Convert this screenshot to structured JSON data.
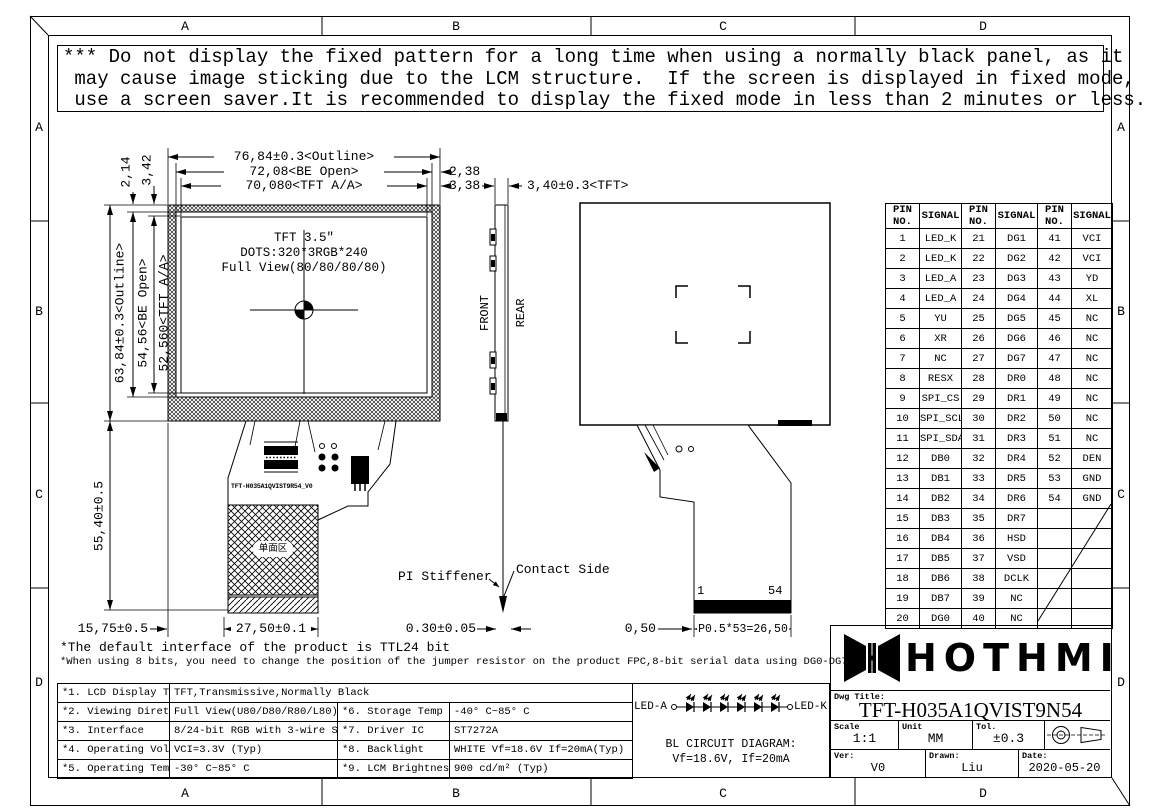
{
  "border": {
    "top": [
      "A",
      "B",
      "C",
      "D"
    ],
    "bottom": [
      "A",
      "B",
      "C",
      "D"
    ],
    "left": [
      "A",
      "B",
      "C",
      "D"
    ],
    "right": [
      "A",
      "B",
      "C",
      "D"
    ]
  },
  "warning": {
    "line1": "*** Do not display the fixed pattern for a long time when using a normally black panel, as it",
    "line2": " may cause image sticking due to the LCM structure.  If the screen is displayed in fixed mode,",
    "line3": " use a screen saver.It is recommended to display the fixed mode in less than 2 minutes or less."
  },
  "front_view": {
    "line1": "TFT 3.5″",
    "line2": "DOTS:320*3RGB*240",
    "line3": "Full View(80/80/80/80)",
    "fpc_part_number": "TFT-H035A1QVIST9R54_V0",
    "stiffener_area_label": "单面区"
  },
  "dims": {
    "outline_w": "76,84±0.3<Outline>",
    "be_open_w": "72,08<BE Open>",
    "tft_aa_w": "70,080<TFT A/A>",
    "right_margin": "2,38",
    "aa_margin": "3,38",
    "thickness": "3,40±0.3<TFT>",
    "top_margin": "2,14",
    "aa_top_margin": "3,42",
    "outline_h": "63,84±0.3<Outline>",
    "be_open_h": "54,56<BE Open>",
    "tft_aa_h": "52,560<TFT A/A>",
    "fpc_len": "55,40±0.5",
    "fpc_left": "15,75±0.5",
    "stiffener_w": "27,50±0.1",
    "fpc_thick": "0.30±0.05",
    "pin_edge": "0,50",
    "pin_pitch": "P0.5*53=26,50"
  },
  "side_view": {
    "front": "FRONT",
    "rear": "REAR",
    "pi_stiffener": "PI Stiffener",
    "contact_side": "Contact Side"
  },
  "rear_view": {
    "first_pin": "1",
    "last_pin": "54"
  },
  "pin_table": {
    "headers": [
      "PIN NO.",
      "SIGNAL",
      "PIN NO.",
      "SIGNAL",
      "PIN NO.",
      "SIGNAL"
    ],
    "rows": [
      [
        "1",
        "LED_K",
        "21",
        "DG1",
        "41",
        "VCI"
      ],
      [
        "2",
        "LED_K",
        "22",
        "DG2",
        "42",
        "VCI"
      ],
      [
        "3",
        "LED_A",
        "23",
        "DG3",
        "43",
        "YD"
      ],
      [
        "4",
        "LED_A",
        "24",
        "DG4",
        "44",
        "XL"
      ],
      [
        "5",
        "YU",
        "25",
        "DG5",
        "45",
        "NC"
      ],
      [
        "6",
        "XR",
        "26",
        "DG6",
        "46",
        "NC"
      ],
      [
        "7",
        "NC",
        "27",
        "DG7",
        "47",
        "NC"
      ],
      [
        "8",
        "RESX",
        "28",
        "DR0",
        "48",
        "NC"
      ],
      [
        "9",
        "SPI_CS",
        "29",
        "DR1",
        "49",
        "NC"
      ],
      [
        "10",
        "SPI_SCL",
        "30",
        "DR2",
        "50",
        "NC"
      ],
      [
        "11",
        "SPI_SDA",
        "31",
        "DR3",
        "51",
        "NC"
      ],
      [
        "12",
        "DB0",
        "32",
        "DR4",
        "52",
        "DEN"
      ],
      [
        "13",
        "DB1",
        "33",
        "DR5",
        "53",
        "GND"
      ],
      [
        "14",
        "DB2",
        "34",
        "DR6",
        "54",
        "GND"
      ],
      [
        "15",
        "DB3",
        "35",
        "DR7",
        "",
        ""
      ],
      [
        "16",
        "DB4",
        "36",
        "HSD",
        "",
        ""
      ],
      [
        "17",
        "DB5",
        "37",
        "VSD",
        "",
        ""
      ],
      [
        "18",
        "DB6",
        "38",
        "DCLK",
        "",
        ""
      ],
      [
        "19",
        "DB7",
        "39",
        "NC",
        "",
        ""
      ],
      [
        "20",
        "DG0",
        "40",
        "NC",
        "",
        ""
      ]
    ]
  },
  "notes": {
    "line1": "*The default interface of the product is TTL24 bit",
    "line2": "*When using 8 bits, you need to change the position of the jumper resistor on the product FPC,8-bit serial data using DG0-DG7"
  },
  "spec_table": {
    "r1c1": "*1. LCD Display Type",
    "r1c2": "TFT,Transmissive,Normally Black",
    "r2c1": "*2. Viewing Diretion",
    "r2c2": "Full View(U80/D80/R80/L80)",
    "r2c3": "*6. Storage Temp",
    "r2c4": "-40° C~85° C",
    "r3c1": "*3. Interface",
    "r3c2": "8/24-bit RGB with 3-wire SPI",
    "r3c3": "*7. Driver IC",
    "r3c4": "ST7272A",
    "r4c1": "*4. Operating Voltage",
    "r4c2": "VCI=3.3V (Typ)",
    "r4c3": "*8. Backlight",
    "r4c4": "WHITE Vf=18.6V If=20mA(Typ)",
    "r5c1": "*5. Operating Temp",
    "r5c2": "-30° C~85° C",
    "r5c3": "*9. LCM Brightness",
    "r5c4": "900 cd/m² (Typ)"
  },
  "bl_circuit": {
    "led_a": "LED-A",
    "led_k": "LED-K",
    "title": "BL CIRCUIT DIAGRAM:",
    "subtitle": "Vf=18.6V, If=20mA"
  },
  "title_block": {
    "logo_text": "HOTHMI",
    "dwg_title_label": "Dwg Title:",
    "dwg_title": "TFT-H035A1QVIST9N54",
    "scale_label": "Scale",
    "scale": "1:1",
    "unit_label": "Unit",
    "unit": "MM",
    "tol_label": "Tol.",
    "tol": "±0.3",
    "ver_label": "Ver:",
    "ver": "V0",
    "drawn_label": "Drawn:",
    "drawn": "Liu",
    "date_label": "Date:",
    "date": "2020-05-20"
  }
}
